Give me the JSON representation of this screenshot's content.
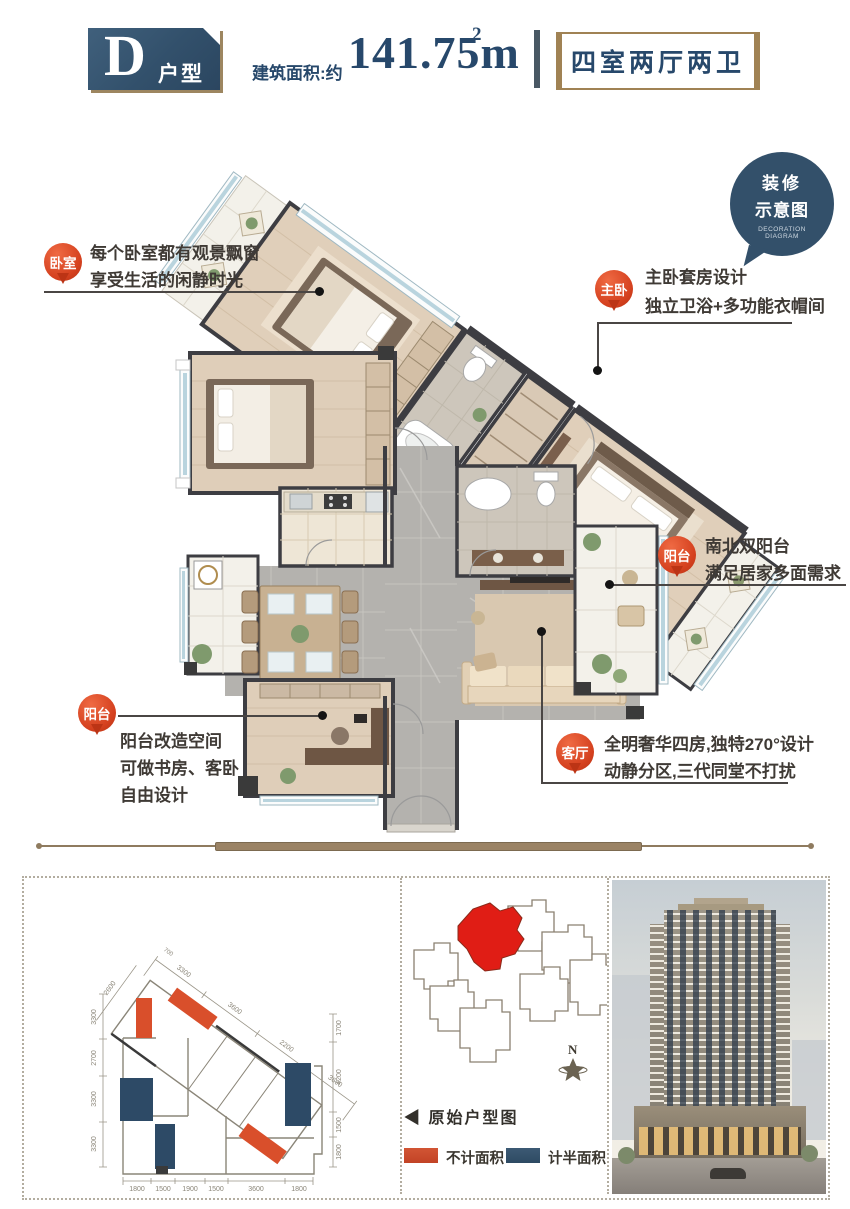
{
  "header": {
    "unit_letter": "D",
    "unit_type_label": "户型",
    "area_label": "建筑面积:约",
    "area_value": "141.75m",
    "area_superscript": "2",
    "rooms_label": "四室两厅两卫"
  },
  "decoration_badge": {
    "line1": "装修",
    "line2": "示意图",
    "en_line1": "DECORATION",
    "en_line2": "DIAGRAM"
  },
  "callouts": {
    "bedroom": {
      "tag": "卧室",
      "lines": [
        "每个卧室都有观景飘窗",
        "享受生活的闲静时光"
      ]
    },
    "master": {
      "tag": "主卧",
      "lines": [
        "主卧套房设计",
        "独立卫浴+多功能衣帽间"
      ]
    },
    "balcony_right": {
      "tag": "阳台",
      "lines": [
        "南北双阳台",
        "满足居家多面需求"
      ]
    },
    "balcony_left": {
      "tag": "阳台",
      "lines": [
        "阳台改造空间",
        "可做书房、客卧",
        "自由设计"
      ]
    },
    "living": {
      "tag": "客厅",
      "lines": [
        "全明奢华四房,独特270°设计",
        "动静分区,三代同堂不打扰"
      ]
    }
  },
  "footer": {
    "original_plan_label": "◀ 原始户型图",
    "legend": [
      {
        "label": "不计面积",
        "color": "#cc4a2b"
      },
      {
        "label": "计半面积",
        "color": "#2e4a63"
      }
    ],
    "compass": "N",
    "dims": {
      "bottom": [
        "1800",
        "1500",
        "1900",
        "1500",
        "3600",
        "1800"
      ],
      "left": [
        "3300",
        "2700",
        "3300",
        "3300"
      ],
      "right": [
        "1700",
        "4200",
        "1500",
        "1800"
      ],
      "diagonal": [
        "2600",
        "3300",
        "3600",
        "2200",
        "3600",
        "700"
      ]
    }
  },
  "colors": {
    "navy": "#31506b",
    "gold": "#a08254",
    "pin_red": "#d5411f",
    "site_highlight_red": "#e01d15",
    "legend_red": "#cc4a2b",
    "legend_blue": "#2e4a63",
    "wall_dark": "#3d3d42",
    "marble_gray": "#b4b2ae"
  }
}
